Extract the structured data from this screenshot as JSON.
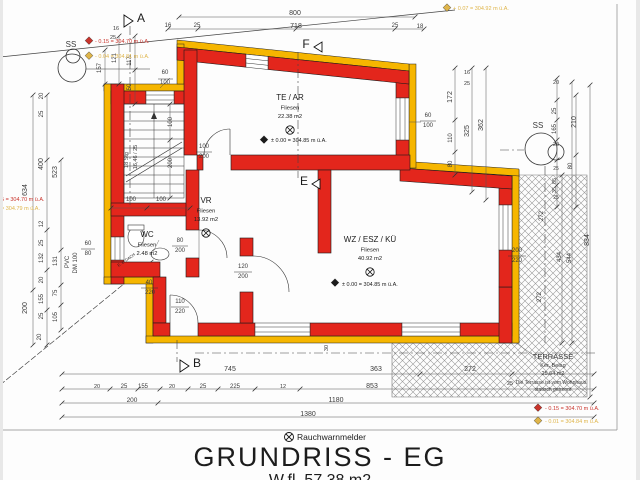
{
  "drawing": {
    "legend_symbol_label": "Rauchwarnmelder",
    "title": "GRUNDRISS - EG",
    "subtitle": "W.fl. 57.38 m2"
  },
  "colors": {
    "wall_red": "#e3261c",
    "insulation_yellow": "#f6b600",
    "dim_text": "#3a3a3a",
    "red_marker": "#c9342c",
    "yellow_marker": "#dfb54a",
    "black_text": "#1c1c1c"
  },
  "rooms": [
    {
      "name": "TE / AR",
      "floor": "Fliesen",
      "area": "22.38 m2",
      "x": 290,
      "y": 100,
      "det": true
    },
    {
      "name": "VR",
      "floor": "Fliesen",
      "area": "13.92 m2",
      "x": 206,
      "y": 203,
      "det": true
    },
    {
      "name": "WC",
      "floor": "Fliesen",
      "area": "2.48 m2",
      "x": 147,
      "y": 237,
      "det": false
    },
    {
      "name": "WZ / ESZ / KÜ",
      "floor": "Fliesen",
      "area": "40.92 m2",
      "x": 370,
      "y": 242,
      "det": true
    }
  ],
  "annotations": [
    {
      "t": "800",
      "x": 295,
      "y": 15
    },
    {
      "t": "16",
      "x": 168,
      "y": 27,
      "s": 6
    },
    {
      "t": "25",
      "x": 197,
      "y": 27,
      "s": 6
    },
    {
      "t": "718",
      "x": 296,
      "y": 28
    },
    {
      "t": "25",
      "x": 395,
      "y": 27,
      "s": 6
    },
    {
      "t": "18",
      "x": 420,
      "y": 28,
      "s": 6
    },
    {
      "t": "634",
      "x": 27,
      "y": 190,
      "r": -90
    },
    {
      "t": "200",
      "x": 27,
      "y": 308,
      "r": -90
    },
    {
      "t": "20",
      "x": 43,
      "y": 96,
      "r": -90,
      "s": 6
    },
    {
      "t": "25",
      "x": 43,
      "y": 114,
      "r": -90,
      "s": 6
    },
    {
      "t": "400",
      "x": 43,
      "y": 164,
      "r": -90
    },
    {
      "t": "12",
      "x": 43,
      "y": 224,
      "r": -90,
      "s": 6
    },
    {
      "t": "25",
      "x": 43,
      "y": 243,
      "r": -90,
      "s": 6
    },
    {
      "t": "132",
      "x": 43,
      "y": 258,
      "r": -90,
      "s": 6
    },
    {
      "t": "20",
      "x": 43,
      "y": 280,
      "r": -90,
      "s": 6
    },
    {
      "t": "155",
      "x": 43,
      "y": 299,
      "r": -90,
      "s": 6
    },
    {
      "t": "25",
      "x": 43,
      "y": 316,
      "r": -90,
      "s": 6
    },
    {
      "t": "20",
      "x": 41,
      "y": 337,
      "r": -90,
      "s": 6
    },
    {
      "t": "523",
      "x": 57,
      "y": 172,
      "r": -90
    },
    {
      "t": "131",
      "x": 57,
      "y": 261,
      "r": -90,
      "s": 6
    },
    {
      "t": "75",
      "x": 57,
      "y": 293,
      "r": -90,
      "s": 6
    },
    {
      "t": "105",
      "x": 57,
      "y": 317,
      "r": -90,
      "s": 6
    },
    {
      "t": "60",
      "x": 88,
      "y": 245,
      "s": 6
    },
    {
      "t": "80",
      "x": 88,
      "y": 255,
      "s": 6
    },
    {
      "t": "PVC",
      "x": 69,
      "y": 262,
      "r": -90,
      "s": 6
    },
    {
      "t": "DM 100",
      "x": 77,
      "y": 263,
      "r": -90,
      "s": 6
    },
    {
      "t": "157",
      "x": 101,
      "y": 68,
      "r": -90,
      "s": 6
    },
    {
      "t": "121",
      "x": 116,
      "y": 58,
      "r": -90,
      "s": 6
    },
    {
      "t": "117",
      "x": 131,
      "y": 61,
      "r": -90,
      "s": 6
    },
    {
      "t": "50",
      "x": 131,
      "y": 87,
      "r": -90,
      "s": 6
    },
    {
      "t": "16",
      "x": 116,
      "y": 30,
      "s": 5.5
    },
    {
      "t": "25",
      "x": 113,
      "y": 39,
      "s": 5.5
    },
    {
      "t": "60",
      "x": 165,
      "y": 74,
      "s": 6
    },
    {
      "t": "100",
      "x": 165,
      "y": 84,
      "s": 6
    },
    {
      "t": "172",
      "x": 452,
      "y": 97,
      "r": -90
    },
    {
      "t": "110",
      "x": 452,
      "y": 138,
      "r": -90,
      "s": 6
    },
    {
      "t": "80",
      "x": 452,
      "y": 164,
      "r": -90,
      "s": 6
    },
    {
      "t": "16",
      "x": 467,
      "y": 74,
      "s": 5.5
    },
    {
      "t": "25",
      "x": 467,
      "y": 85,
      "s": 5.5
    },
    {
      "t": "325",
      "x": 469,
      "y": 131,
      "r": -90
    },
    {
      "t": "362",
      "x": 483,
      "y": 125,
      "r": -90
    },
    {
      "t": "20",
      "x": 556,
      "y": 84,
      "s": 5.5
    },
    {
      "t": "25",
      "x": 556,
      "y": 111,
      "r": -90,
      "s": 6
    },
    {
      "t": "165",
      "x": 556,
      "y": 129,
      "r": -90,
      "s": 6
    },
    {
      "t": "20",
      "x": 556,
      "y": 146,
      "s": 5.5
    },
    {
      "t": "80",
      "x": 572,
      "y": 166,
      "r": -90,
      "s": 6
    },
    {
      "t": "25",
      "x": 556,
      "y": 170,
      "s": 5
    },
    {
      "t": "85",
      "x": 556,
      "y": 181,
      "r": -90,
      "s": 5.5
    },
    {
      "t": "35",
      "x": 556,
      "y": 190,
      "r": -90,
      "s": 5.5
    },
    {
      "t": "25",
      "x": 556,
      "y": 199,
      "s": 5
    },
    {
      "t": "210",
      "x": 576,
      "y": 122,
      "r": -90
    },
    {
      "t": "272",
      "x": 543,
      "y": 216,
      "r": -90,
      "s": 6
    },
    {
      "t": "272",
      "x": 541,
      "y": 297,
      "r": -90,
      "s": 6
    },
    {
      "t": "834",
      "x": 589,
      "y": 240,
      "r": -90
    },
    {
      "t": "434",
      "x": 561,
      "y": 257,
      "r": -90,
      "s": 6
    },
    {
      "t": "544",
      "x": 571,
      "y": 258,
      "r": -90,
      "s": 6
    },
    {
      "t": "200",
      "x": 517,
      "y": 252,
      "s": 6
    },
    {
      "t": "220",
      "x": 517,
      "y": 262,
      "s": 6
    },
    {
      "t": "SS",
      "x": 71,
      "y": 47,
      "s": 8
    },
    {
      "t": "SS",
      "x": 538,
      "y": 128,
      "s": 8
    },
    {
      "t": "100",
      "x": 131,
      "y": 201,
      "s": 6
    },
    {
      "t": "100",
      "x": 161,
      "y": 201,
      "s": 6
    },
    {
      "t": "100",
      "x": 172,
      "y": 122,
      "r": -90,
      "s": 6
    },
    {
      "t": "200",
      "x": 172,
      "y": 163,
      "r": -90,
      "s": 6
    },
    {
      "t": "18 Stg",
      "x": 128,
      "y": 160,
      "r": -90,
      "s": 5.5
    },
    {
      "t": "16,46 / 25",
      "x": 137,
      "y": 157,
      "r": -90,
      "s": 5.5
    },
    {
      "t": "100",
      "x": 204,
      "y": 148,
      "s": 6
    },
    {
      "t": "200",
      "x": 204,
      "y": 158,
      "s": 6
    },
    {
      "t": "60",
      "x": 428,
      "y": 117,
      "s": 6
    },
    {
      "t": "100",
      "x": 428,
      "y": 127,
      "s": 6
    },
    {
      "t": "80",
      "x": 180,
      "y": 242,
      "s": 6
    },
    {
      "t": "200",
      "x": 180,
      "y": 252,
      "s": 6
    },
    {
      "t": "40",
      "x": 149,
      "y": 284,
      "s": 6
    },
    {
      "t": "220",
      "x": 150,
      "y": 294,
      "s": 6
    },
    {
      "t": "110",
      "x": 180,
      "y": 303,
      "s": 6
    },
    {
      "t": "220",
      "x": 180,
      "y": 313,
      "s": 6
    },
    {
      "t": "120",
      "x": 243,
      "y": 268,
      "s": 6
    },
    {
      "t": "200",
      "x": 243,
      "y": 278,
      "s": 6
    },
    {
      "t": "30",
      "x": 328,
      "y": 348,
      "r": -90,
      "s": 5.5
    },
    {
      "t": "± 0.00 = 304.85 m ü.A.",
      "x": 271,
      "y": 142,
      "s": 5.5,
      "a": "start",
      "c": "black"
    },
    {
      "t": "± 0.00 = 304.85 m ü.A.",
      "x": 342,
      "y": 286,
      "s": 5.5,
      "a": "start",
      "c": "black"
    },
    {
      "t": "TERRASSE",
      "x": 553,
      "y": 359,
      "s": 7.5
    },
    {
      "t": "Ker. Belag",
      "x": 553,
      "y": 367,
      "s": 5.5
    },
    {
      "t": "25.64 m2",
      "x": 553,
      "y": 375,
      "s": 5.5
    },
    {
      "t": "Die Terrasse ist vom Wohnhaus",
      "x": 551,
      "y": 384,
      "s": 5
    },
    {
      "t": "statisch getrennt",
      "x": 553,
      "y": 391,
      "s": 5
    },
    {
      "t": "25",
      "x": 510,
      "y": 385,
      "s": 5.5
    },
    {
      "t": "745",
      "x": 230,
      "y": 371
    },
    {
      "t": "363",
      "x": 376,
      "y": 371
    },
    {
      "t": "272",
      "x": 470,
      "y": 371
    },
    {
      "t": "20",
      "x": 97,
      "y": 388,
      "s": 5.5
    },
    {
      "t": "25",
      "x": 124,
      "y": 388,
      "s": 6
    },
    {
      "t": "155",
      "x": 143,
      "y": 388,
      "s": 6
    },
    {
      "t": "20",
      "x": 172,
      "y": 388,
      "s": 5.5
    },
    {
      "t": "25",
      "x": 203,
      "y": 388,
      "s": 6
    },
    {
      "t": "225",
      "x": 235,
      "y": 388,
      "s": 6
    },
    {
      "t": "12",
      "x": 283,
      "y": 388,
      "s": 5.5
    },
    {
      "t": "853",
      "x": 372,
      "y": 388
    },
    {
      "t": "200",
      "x": 132,
      "y": 402,
      "s": 6.5
    },
    {
      "t": "1180",
      "x": 336,
      "y": 402
    },
    {
      "t": "1380",
      "x": 308,
      "y": 416
    },
    {
      "t": "A",
      "x": 141,
      "y": 22,
      "s": 12,
      "c": "black",
      "n": "section-marker-a"
    },
    {
      "t": "B",
      "x": 197,
      "y": 367,
      "s": 12,
      "c": "black",
      "n": "section-marker-b"
    },
    {
      "t": "F",
      "x": 306,
      "y": 48,
      "s": 12,
      "c": "black",
      "n": "section-marker-f"
    },
    {
      "t": "E",
      "x": 304,
      "y": 185,
      "s": 12,
      "c": "black",
      "n": "section-marker-e"
    },
    {
      "t": "- 0.15 = 304.70 m ü.A.",
      "x": 95,
      "y": 43,
      "s": 5.5,
      "a": "start",
      "c": "red",
      "n": "elevation-note"
    },
    {
      "t": "- 0.04 = 304.81 m ü.A.",
      "x": 95,
      "y": 58,
      "s": 5.5,
      "a": "start",
      "c": "yellow",
      "n": "elevation-note"
    },
    {
      "t": "+ 0.07 = 304.92 m ü.A.",
      "x": 453,
      "y": 10,
      "s": 5.5,
      "a": "start",
      "c": "yellow",
      "n": "elevation-note"
    },
    {
      "t": "- 0.15 = 304.70 m ü.A.",
      "x": 545,
      "y": 410,
      "s": 5.5,
      "a": "start",
      "c": "red",
      "n": "elevation-note"
    },
    {
      "t": "- 0.01 = 304.84 m ü.A.",
      "x": 545,
      "y": 423,
      "s": 5.5,
      "a": "start",
      "c": "yellow",
      "n": "elevation-note"
    },
    {
      "t": "5 = 304.70 m ü.A.",
      "x": 1,
      "y": 201,
      "s": 5.5,
      "a": "start",
      "c": "red",
      "n": "elevation-note"
    },
    {
      "t": "= 304.79 m ü.A.",
      "x": 1,
      "y": 210,
      "s": 5.5,
      "a": "start",
      "c": "yellow",
      "n": "elevation-note"
    },
    {
      "t": "E. z. DACH",
      "x": 127,
      "y": 261,
      "r": -35,
      "s": 4,
      "c": "black"
    }
  ]
}
